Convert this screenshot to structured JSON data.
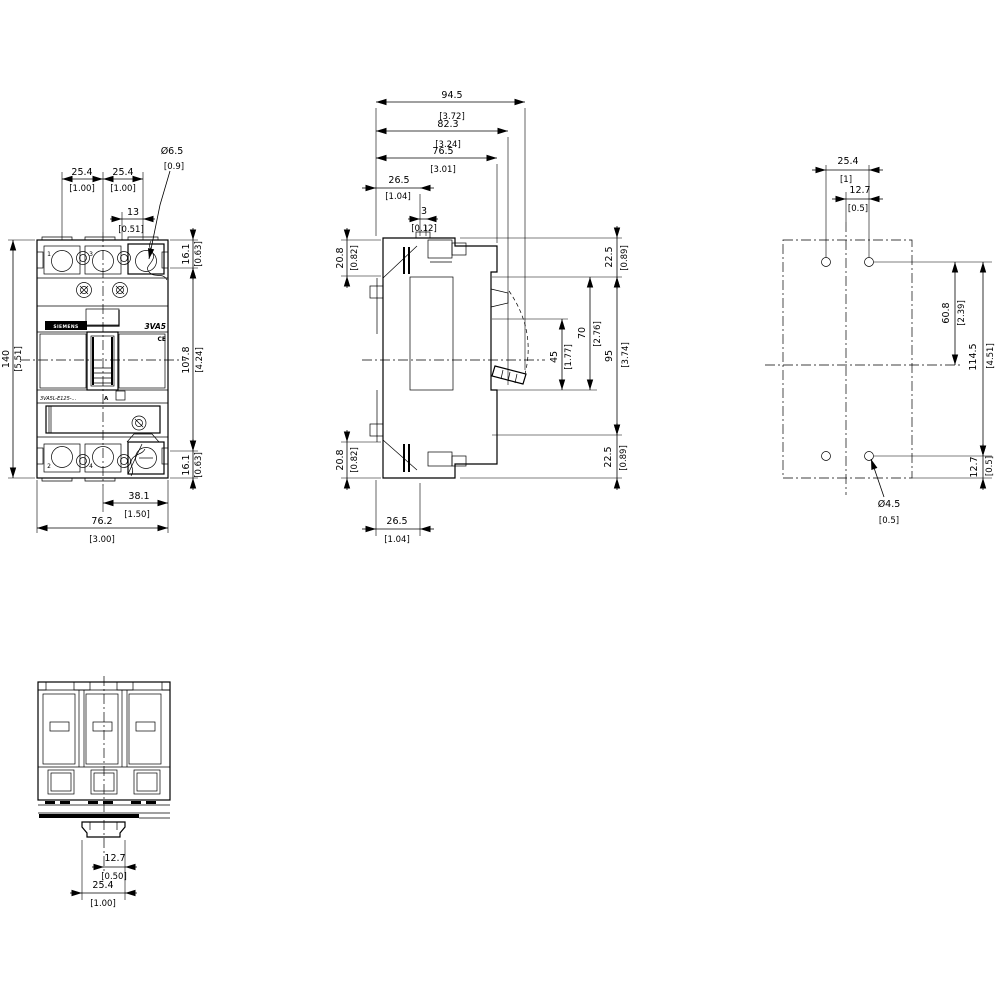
{
  "front_view": {
    "dims": {
      "pole_pitch_1": {
        "mm": "25.4",
        "in": "[1.00]"
      },
      "pole_pitch_2": {
        "mm": "25.4",
        "in": "[1.00]"
      },
      "hole_offset": {
        "mm": "13",
        "in": "[0.51]"
      },
      "terminal_hole_dia": {
        "mm": "Ø6.5",
        "in": "[0.9]"
      },
      "height_total": {
        "mm": "140",
        "in": "[5.51]"
      },
      "height_top_terminal": {
        "mm": "16.1",
        "in": "[0.63]"
      },
      "height_body": {
        "mm": "107.8",
        "in": "[4.24]"
      },
      "height_bot_terminal": {
        "mm": "16.1",
        "in": "[0.63]"
      },
      "width_center_edge": {
        "mm": "38.1",
        "in": "[1.50]"
      },
      "width_total": {
        "mm": "76.2",
        "in": "[3.00]"
      }
    },
    "labels": {
      "brand": "SIEMENS",
      "series": "3VA5",
      "ce_mark": "CE",
      "catalog": "3VA5L-E125-...",
      "rating": "A",
      "pole_top_1": "1",
      "pole_top_2": "3",
      "pole_bottom_1": "2",
      "pole_bottom_2": "4"
    }
  },
  "side_view": {
    "dims": {
      "depth_total": {
        "mm": "94.5",
        "in": "[3.72]"
      },
      "depth_handle_base": {
        "mm": "82.3",
        "in": "[3.24]"
      },
      "depth_body": {
        "mm": "76.5",
        "in": "[3.01]"
      },
      "depth_din_zone": {
        "mm": "26.5",
        "in": "[1.04]"
      },
      "din_step": {
        "mm": "3",
        "in": "[0.12]"
      },
      "terminal_depth_top": {
        "mm": "20.8",
        "in": "[0.82]"
      },
      "terminal_depth_bot": {
        "mm": "20.8",
        "in": "[0.82]"
      },
      "height_top_zone": {
        "mm": "22.5",
        "in": "[0.89]"
      },
      "handle_cutout_45": {
        "mm": "45",
        "in": "[1.77]"
      },
      "handle_cutout_70": {
        "mm": "70",
        "in": "[2.76]"
      },
      "height_mid_zone": {
        "mm": "95",
        "in": "[3.74]"
      },
      "height_bot_zone": {
        "mm": "22.5",
        "in": "[0.89]"
      },
      "depth_din_bottom": {
        "mm": "26.5",
        "in": "[1.04]"
      }
    }
  },
  "drilling_plan": {
    "dims": {
      "hole_pitch_x": {
        "mm": "25.4",
        "in": "[1]"
      },
      "hole_to_center": {
        "mm": "12.7",
        "in": "[0.5]"
      },
      "hole_to_mid_y": {
        "mm": "60.8",
        "in": "[2.39]"
      },
      "hole_pitch_y": {
        "mm": "114.5",
        "in": "[4.51]"
      },
      "hole_to_edge": {
        "mm": "12.7",
        "in": "[0.5]"
      },
      "mounting_hole_dia": {
        "mm": "Ø4.5",
        "in": "[0.5]"
      }
    }
  },
  "bottom_view": {
    "dims": {
      "tab_half_width": {
        "mm": "12.7",
        "in": "[0.50]"
      },
      "tab_width": {
        "mm": "25.4",
        "in": "[1.00]"
      }
    }
  }
}
